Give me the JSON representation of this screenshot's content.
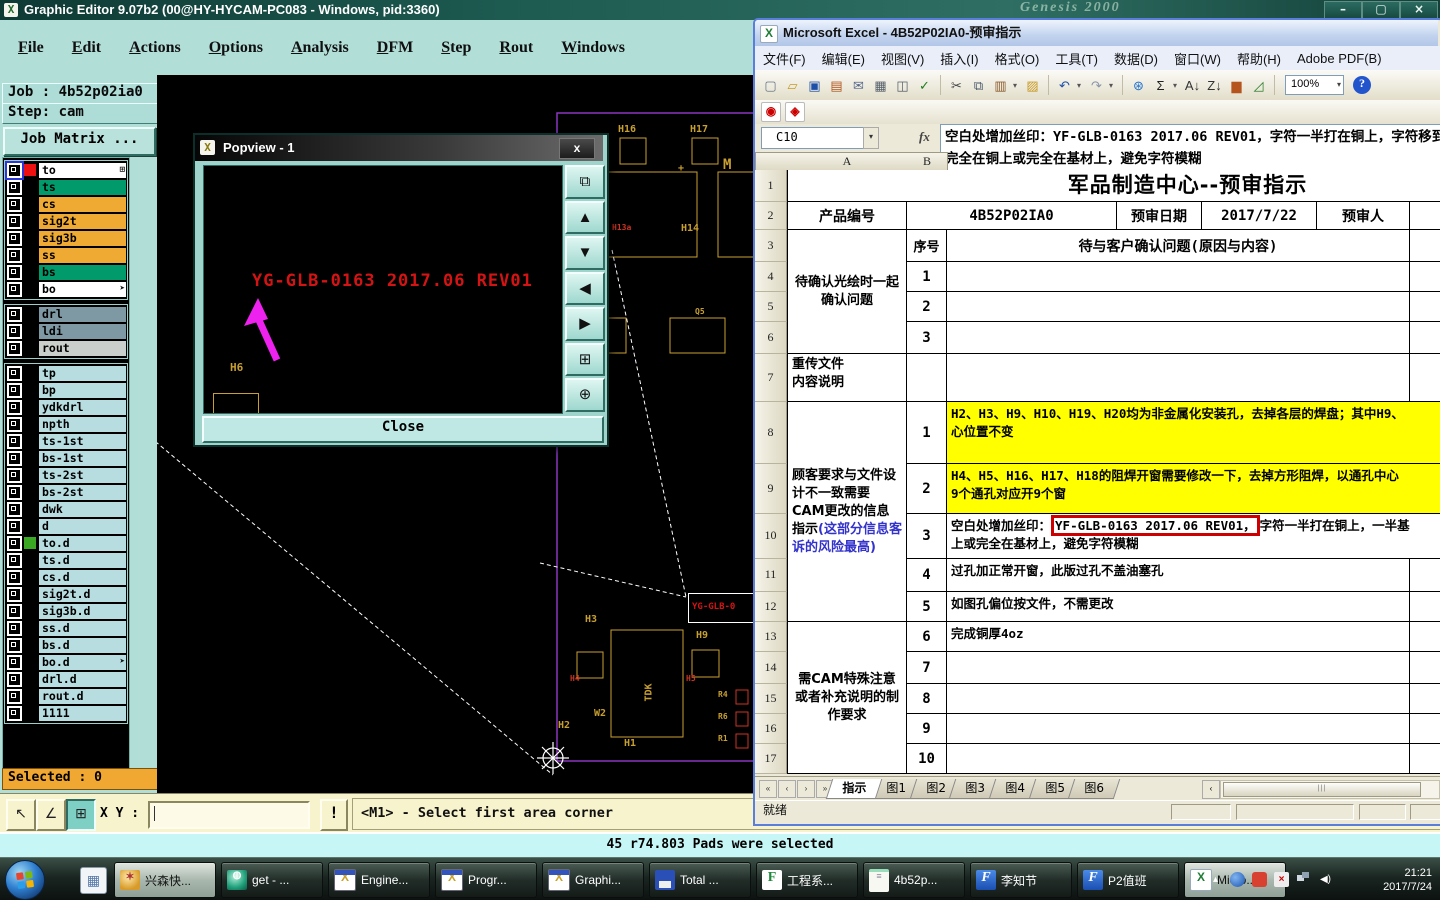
{
  "graphic_editor": {
    "title": "Graphic Editor 9.07b2 (00@HY-HYCAM-PC083 - Windows, pid:3360)",
    "titlebar_ghost": "Genesis 2000",
    "window_controls": [
      {
        "name": "minimize-icon",
        "glyph": "–"
      },
      {
        "name": "restore-icon",
        "glyph": "▢"
      },
      {
        "name": "close-icon",
        "glyph": "×"
      }
    ],
    "menus": [
      "File",
      "Edit",
      "Actions",
      "Options",
      "Analysis",
      "DFM",
      "Step",
      "Rout",
      "Windows"
    ],
    "job_label": "Job : 4b52p02ia0",
    "step_label": "Step: cam",
    "job_matrix_button": "Job Matrix ...",
    "layers_group1": [
      {
        "label": "to",
        "bg": "#ffffff",
        "swatch": "#ee1111",
        "selected": true,
        "icon": "grid"
      },
      {
        "label": "ts",
        "bg": "#009a6b"
      },
      {
        "label": "cs",
        "bg": "#eeaa33"
      },
      {
        "label": "sig2t",
        "bg": "#eeaa33"
      },
      {
        "label": "sig3b",
        "bg": "#eeaa33"
      },
      {
        "label": "ss",
        "bg": "#eeaa33"
      },
      {
        "label": "bs",
        "bg": "#009a6b"
      },
      {
        "label": "bo",
        "bg": "#ffffff",
        "icon": "arrow"
      }
    ],
    "layers_group2": [
      {
        "label": "drl",
        "bg": "#7e99a3"
      },
      {
        "label": "ldi",
        "bg": "#7e99a3"
      },
      {
        "label": "rout",
        "bg": "#cbcfcb"
      }
    ],
    "layers_group3": [
      {
        "label": "tp"
      },
      {
        "label": "bp"
      },
      {
        "label": "ydkdrl"
      },
      {
        "label": "npth"
      },
      {
        "label": "ts-1st"
      },
      {
        "label": "bs-1st"
      },
      {
        "label": "ts-2st"
      },
      {
        "label": "bs-2st"
      },
      {
        "label": "dwk"
      },
      {
        "label": "d"
      },
      {
        "label": "to.d",
        "swatch": "#3aa822"
      },
      {
        "label": "ts.d"
      },
      {
        "label": "cs.d"
      },
      {
        "label": "sig2t.d"
      },
      {
        "label": "sig3b.d"
      },
      {
        "label": "ss.d"
      },
      {
        "label": "bs.d"
      },
      {
        "label": "bo.d",
        "icon": "arrow"
      },
      {
        "label": "drl.d"
      },
      {
        "label": "rout.d"
      },
      {
        "label": "1111"
      }
    ],
    "selected_label": "Selected : 0",
    "bottom_tools": [
      {
        "name": "select-arrow-icon",
        "glyph": "↖"
      },
      {
        "name": "snap-angle-icon",
        "glyph": "∠"
      },
      {
        "name": "grid-window-icon",
        "glyph": "⊞",
        "pressed": true
      }
    ],
    "xy_label": "X Y :",
    "alert_button": "!",
    "prompt": "<M1> - Select first area corner",
    "status": "45 r74.803 Pads were selected",
    "canvas": {
      "yg_rect_text": "YG-GLB-0",
      "labels": [
        {
          "t": "H16",
          "x": 461,
          "y": 49,
          "c": "#c8a030"
        },
        {
          "t": "H17",
          "x": 533,
          "y": 49,
          "c": "#c8a030"
        },
        {
          "t": "+",
          "x": 521,
          "y": 88,
          "c": "#c8a030"
        },
        {
          "t": "M",
          "x": 566,
          "y": 82,
          "c": "#c8a030",
          "s": 14
        },
        {
          "t": "H13a",
          "x": 455,
          "y": 148,
          "c": "#cc3322",
          "s": 8
        },
        {
          "t": "H14",
          "x": 524,
          "y": 148,
          "c": "#c8a030"
        },
        {
          "t": "Q5",
          "x": 538,
          "y": 232,
          "c": "#c8a030",
          "s": 8
        },
        {
          "t": "H3",
          "x": 428,
          "y": 539,
          "c": "#c8a030"
        },
        {
          "t": "H9",
          "x": 539,
          "y": 555,
          "c": "#c8a030"
        },
        {
          "t": "H4",
          "x": 413,
          "y": 599,
          "c": "#cc3322",
          "s": 8
        },
        {
          "t": "H5",
          "x": 529,
          "y": 599,
          "c": "#cc3322",
          "s": 8
        },
        {
          "t": "TDK",
          "x": 483,
          "y": 612,
          "c": "#c8a030",
          "rot": -90
        },
        {
          "t": "W2",
          "x": 437,
          "y": 633,
          "c": "#c8a030"
        },
        {
          "t": "H2",
          "x": 401,
          "y": 645,
          "c": "#c8a030"
        },
        {
          "t": "H1",
          "x": 467,
          "y": 663,
          "c": "#c8a030"
        },
        {
          "t": "R4",
          "x": 561,
          "y": 615,
          "c": "#c8a030",
          "s": 8
        },
        {
          "t": "R6",
          "x": 561,
          "y": 637,
          "c": "#c8a030",
          "s": 8
        },
        {
          "t": "R1",
          "x": 561,
          "y": 659,
          "c": "#c8a030",
          "s": 8
        }
      ]
    }
  },
  "popview": {
    "title": "Popview - 1",
    "close_x": "x",
    "overlay_text": "YG-GLB-0163 2017.06 REV01",
    "h6_label": "H6",
    "close_button": "Close",
    "tools": [
      {
        "name": "copy-window-icon",
        "glyph": "⧉"
      },
      {
        "name": "pan-up-icon",
        "glyph": "▲"
      },
      {
        "name": "pan-down-icon",
        "glyph": "▼"
      },
      {
        "name": "pan-left-icon",
        "glyph": "◀"
      },
      {
        "name": "pan-right-icon",
        "glyph": "▶"
      },
      {
        "name": "zoom-fit-icon",
        "glyph": "⊞"
      },
      {
        "name": "zoom-center-icon",
        "glyph": "⊕"
      }
    ]
  },
  "excel": {
    "title": "Microsoft Excel - 4B52P02IA0-预审指示",
    "menus": [
      "文件(F)",
      "编辑(E)",
      "视图(V)",
      "插入(I)",
      "格式(O)",
      "工具(T)",
      "数据(D)",
      "窗口(W)",
      "帮助(H)",
      "Adobe PDF(B)"
    ],
    "toolbar": {
      "zoom": "100%",
      "help": "?",
      "icons": [
        {
          "name": "new-document-icon",
          "glyph": "▢",
          "color": "#667788"
        },
        {
          "name": "open-folder-icon",
          "glyph": "▱",
          "color": "#c99b26"
        },
        {
          "name": "save-icon",
          "glyph": "▣",
          "color": "#1e4fa8"
        },
        {
          "name": "permission-icon",
          "glyph": "▤",
          "color": "#b0541c"
        },
        {
          "name": "email-icon",
          "glyph": "✉",
          "color": "#55678a"
        },
        {
          "name": "print-icon",
          "glyph": "▦",
          "color": "#55606a"
        },
        {
          "name": "print-preview-icon",
          "glyph": "◫",
          "color": "#55606a"
        },
        {
          "name": "spelling-icon",
          "glyph": "✓",
          "color": "#1f7d1f"
        },
        {
          "sep": true
        },
        {
          "name": "cut-icon",
          "glyph": "✂",
          "color": "#444444"
        },
        {
          "name": "copy-icon",
          "glyph": "⧉",
          "color": "#445566"
        },
        {
          "name": "paste-icon",
          "glyph": "▥",
          "color": "#8a5a2a",
          "dd": true
        },
        {
          "name": "format-painter-icon",
          "glyph": "▨",
          "color": "#c99b26"
        },
        {
          "sep": true
        },
        {
          "name": "undo-icon",
          "glyph": "↶",
          "color": "#1e4fa8",
          "dd": true
        },
        {
          "name": "redo-icon",
          "glyph": "↷",
          "color": "#8a93a8",
          "dd": true
        },
        {
          "sep": true
        },
        {
          "name": "hyperlink-icon",
          "glyph": "⊛",
          "color": "#1e6fd0"
        },
        {
          "name": "autosum-icon",
          "glyph": "Σ",
          "color": "#222222",
          "dd": true
        },
        {
          "name": "sort-ascending-icon",
          "glyph": "A↓",
          "color": "#333333"
        },
        {
          "name": "sort-descending-icon",
          "glyph": "Z↓",
          "color": "#333333"
        },
        {
          "name": "chart-wizard-icon",
          "glyph": "▆",
          "color": "#b5541c"
        },
        {
          "name": "drawing-icon",
          "glyph": "◿",
          "color": "#2a7d2a"
        },
        {
          "sep": true
        }
      ],
      "pdf_icons": [
        {
          "name": "pdf-convert-icon",
          "glyph": "◉"
        },
        {
          "name": "pdf-email-icon",
          "glyph": "◈"
        }
      ]
    },
    "name_box": "C10",
    "fx_label": "fx",
    "formula_text": "空白处增加丝印：YF-GLB-0163 2017.06 REV01，字符一半打在铜上，字符移到完全在铜上或完全在基材上，避免字符模糊",
    "columns": [
      "A",
      "B"
    ],
    "row_numbers": [
      "1",
      "2",
      "3",
      "4",
      "5",
      "6",
      "7",
      "8",
      "9",
      "10",
      "11",
      "12",
      "13",
      "14",
      "15",
      "16",
      "17"
    ],
    "sheet": {
      "title": "军品制造中心--预审指示",
      "product_label": "产品编号",
      "product_value": "4B52P02IA0",
      "date_label": "预审日期",
      "date_value": "2017/7/22",
      "reviewer_label": "预审人",
      "seq_header": "序号",
      "confirm_header": "待与客户确认问题(原因与内容)",
      "sec1_label": "待确认光绘时一起确认问题",
      "retransmit_label": "重传文件内容说明",
      "sec2_label": "顾客要求与文件设计不一致需要CAM更改的信息指示",
      "sec2_label_note": "(这部分信息客诉的风险最高)",
      "sec3_label": "需CAM特殊注意或者补充说明的制作要求",
      "g1_rows": [
        {
          "seq": "1",
          "text": ""
        },
        {
          "seq": "2",
          "text": ""
        },
        {
          "seq": "3",
          "text": ""
        }
      ],
      "g2_rows": [
        {
          "seq": "1",
          "highlight": true,
          "text": "H2、H3、H9、H10、H19、H20均为非金属化安装孔，去掉各层的焊盘；其中H9、\n心位置不变"
        },
        {
          "seq": "2",
          "highlight": true,
          "text": "H4、H5、H16、H17、H18的阻焊开窗需要修改一下，去掉方形阻焊，以通孔中心\n9个通孔对应开9个窗"
        },
        {
          "seq": "3",
          "pre": "空白处增加丝印：",
          "boxed": "YF-GLB-0163 2017.06 REV01，",
          "post": "字符一半打在铜上，一半基\n上或完全在基材上，避免字符模糊"
        },
        {
          "seq": "4",
          "text": "过孔加正常开窗，此版过孔不盖油塞孔"
        },
        {
          "seq": "5",
          "text": "如图孔偏位按文件，不需更改"
        }
      ],
      "g3_rows": [
        {
          "seq": "6",
          "text": "完成铜厚4oz"
        },
        {
          "seq": "7",
          "text": ""
        },
        {
          "seq": "8",
          "text": ""
        },
        {
          "seq": "9",
          "text": ""
        },
        {
          "seq": "10",
          "text": ""
        }
      ]
    },
    "tab_nav": [
      {
        "name": "first-sheet-icon",
        "glyph": "«"
      },
      {
        "name": "prev-sheet-icon",
        "glyph": "‹"
      },
      {
        "name": "next-sheet-icon",
        "glyph": "›"
      },
      {
        "name": "last-sheet-icon",
        "glyph": "»"
      }
    ],
    "tabs": [
      "指示",
      "图1",
      "图2",
      "图3",
      "图4",
      "图5",
      "图6"
    ],
    "status": "就绪"
  },
  "taskbar": {
    "items": [
      {
        "label": "兴森快...",
        "icon": "shell",
        "active": true
      },
      {
        "label": "get - ...",
        "icon": "orb"
      },
      {
        "label": "Engine...",
        "icon": "xwin"
      },
      {
        "label": "Progr...",
        "icon": "xwin"
      },
      {
        "label": "Graphi...",
        "icon": "xwin"
      },
      {
        "label": "Total ...",
        "icon": "floppy"
      },
      {
        "label": "工程系...",
        "icon": "fgreen"
      },
      {
        "label": "4b52p...",
        "icon": "notepad"
      },
      {
        "label": "李知节",
        "icon": "fblue"
      },
      {
        "label": "P2值班",
        "icon": "fblue"
      },
      {
        "label": "Micro...",
        "icon": "excel",
        "active": true
      }
    ],
    "clock": {
      "time": "21:21",
      "date": "2017/7/24"
    }
  }
}
